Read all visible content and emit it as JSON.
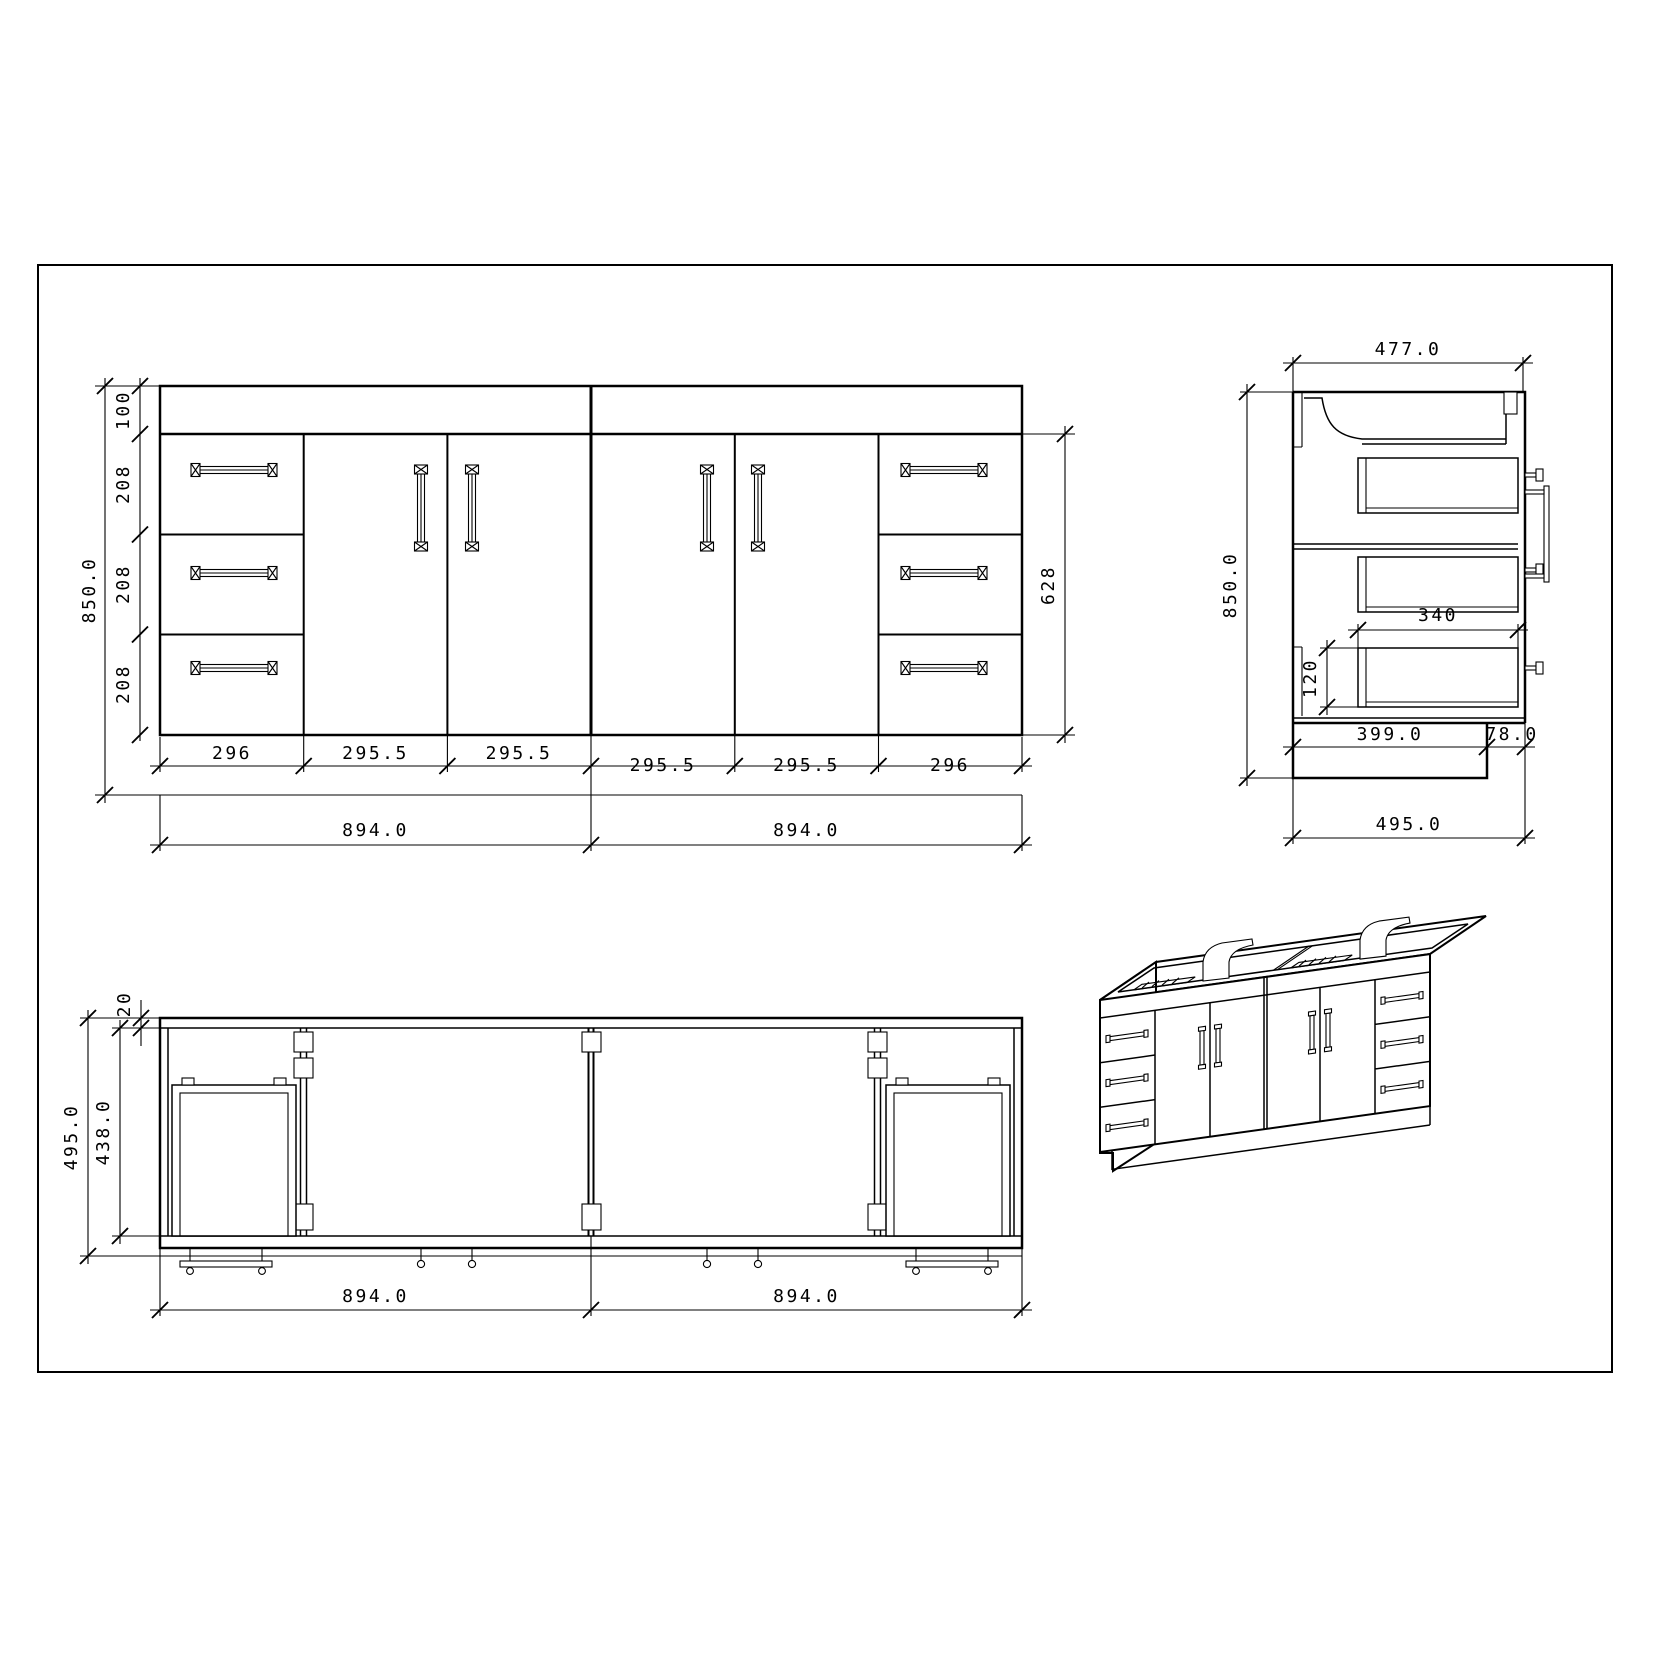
{
  "sheet": {
    "background": "#ffffff",
    "line_color": "#000000",
    "views": [
      "front-elevation",
      "side-section",
      "plan-view",
      "isometric"
    ]
  },
  "dims": {
    "front": {
      "overall_height": "850.0",
      "segments": [
        "100",
        "208",
        "208",
        "208"
      ],
      "door_height": "628",
      "widths": [
        "296",
        "295.5",
        "295.5",
        "295.5",
        "295.5",
        "296"
      ],
      "halves": [
        "894.0",
        "894.0"
      ]
    },
    "side": {
      "top_depth": "477.0",
      "overall_height": "850.0",
      "drawer_depth": "340",
      "drawer_height": "120",
      "toe_depth": "399.0",
      "front_offset": "78.0",
      "overall_depth": "495.0"
    },
    "plan": {
      "back_rail": "20",
      "inner_depth": "438.0",
      "overall_depth": "495.0",
      "halves": [
        "894.0",
        "894.0"
      ]
    }
  }
}
